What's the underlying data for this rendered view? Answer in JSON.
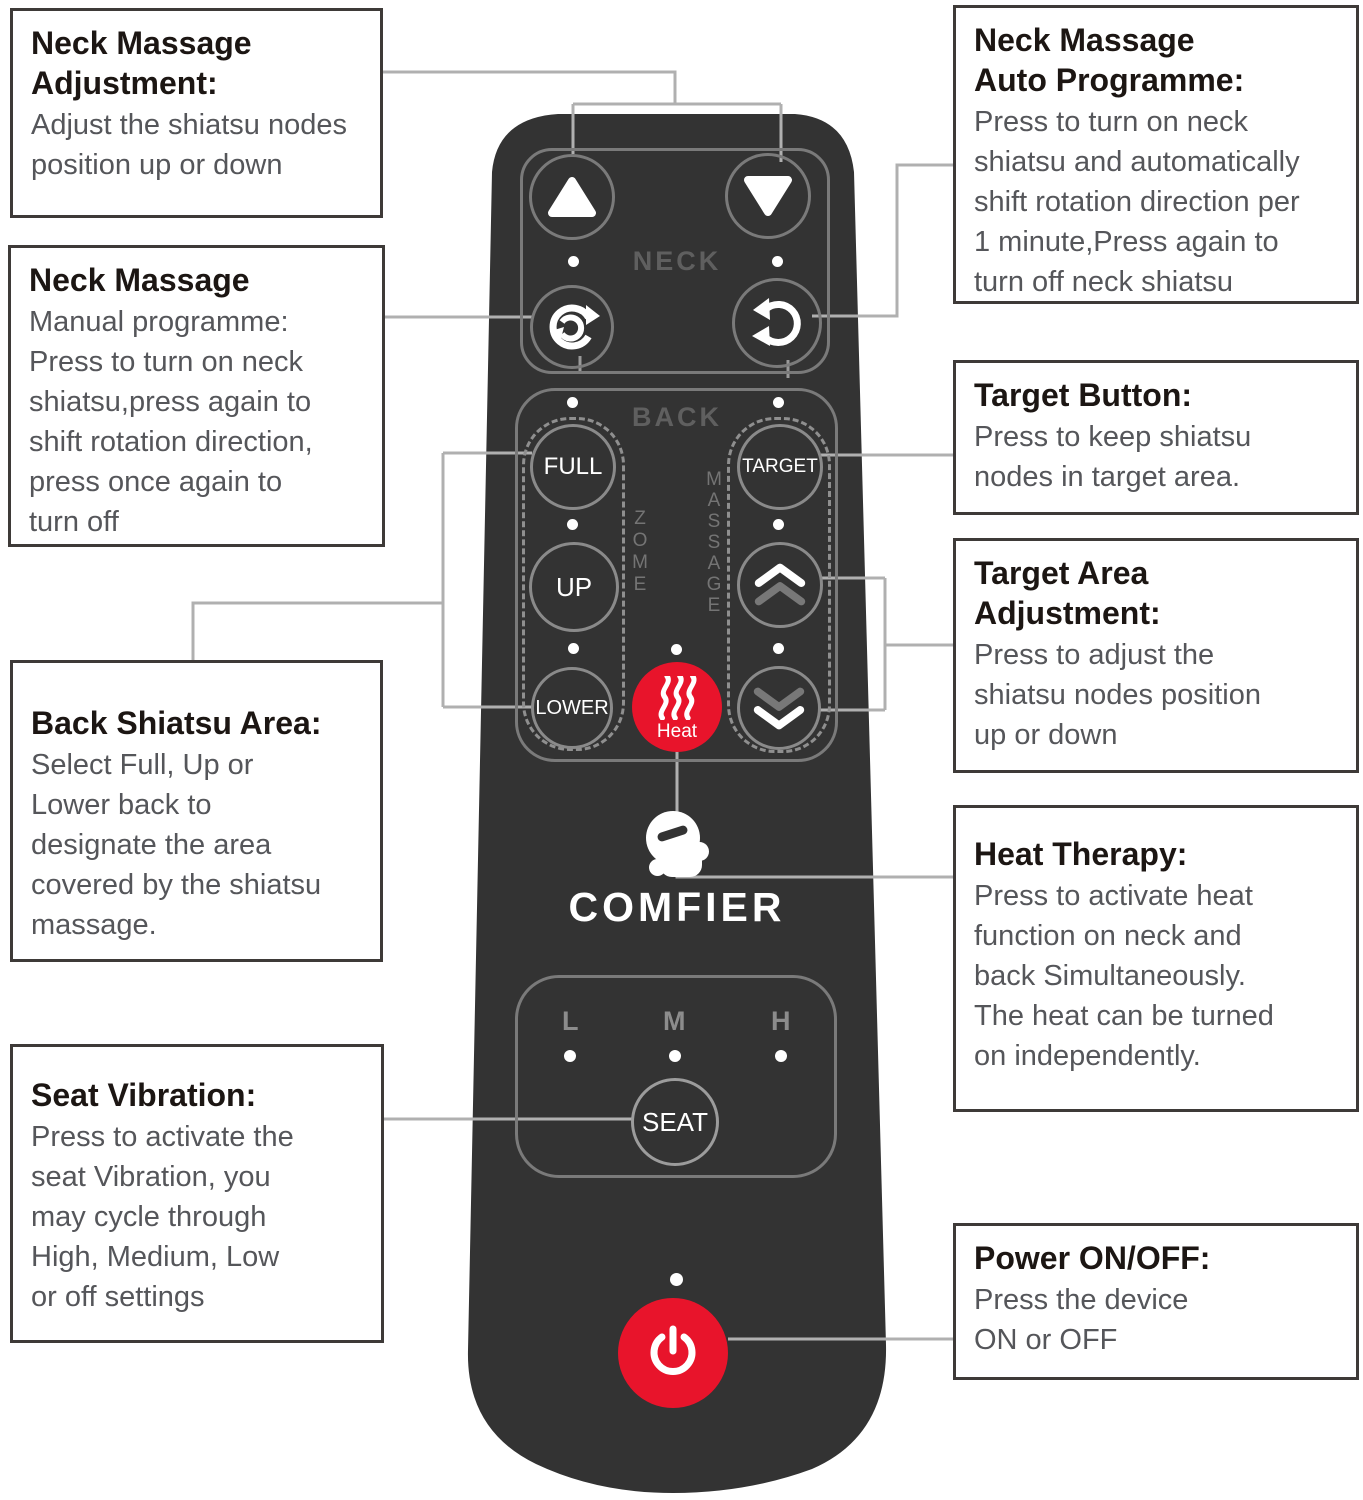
{
  "callouts": {
    "left": [
      {
        "title": "Neck Massage\nAdjustment:",
        "body": "Adjust the shiatsu nodes\nposition up or down"
      },
      {
        "title": "Neck Massage",
        "body": "Manual programme:\nPress to turn on neck\nshiatsu,press again to\nshift rotation direction,\npress once again to\nturn off"
      },
      {
        "title": "Back Shiatsu Area:",
        "body": "Select Full, Up or\nLower back to\ndesignate the area\ncovered by the shiatsu\nmassage."
      },
      {
        "title": "Seat Vibration:",
        "body": "Press to activate the\nseat Vibration, you\nmay cycle through\nHigh, Medium, Low\nor off settings"
      }
    ],
    "right": [
      {
        "title": "Neck Massage\nAuto Programme:",
        "body": "Press to turn on neck\nshiatsu and automatically\nshift rotation direction per\n1 minute,Press again to\nturn off neck shiatsu"
      },
      {
        "title": "Target Button:",
        "body": "Press to keep shiatsu\nnodes in target area."
      },
      {
        "title": "Target Area\nAdjustment:",
        "body": "Press to adjust the\nshiatsu nodes position\nup or down"
      },
      {
        "title": "Heat Therapy:",
        "body": "Press to activate heat\nfunction on neck and\nback Simultaneously.\nThe heat can be turned\non independently."
      },
      {
        "title": "Power ON/OFF:",
        "body": "Press the device\nON or OFF"
      }
    ]
  },
  "remote": {
    "brand": "COMFIER",
    "sections": {
      "neck": "NECK",
      "back": "BACK",
      "zone_vertical": "ZOME",
      "massage_vertical": "MASSAGE"
    },
    "buttons": {
      "full": "FULL",
      "up": "UP",
      "lower": "LOWER",
      "target": "TARGET",
      "heat": "Heat",
      "seat": "SEAT"
    },
    "vibration_levels": {
      "low": "L",
      "medium": "M",
      "high": "H"
    },
    "colors": {
      "body": "#333333",
      "accent_red": "#e8142b",
      "outline_gray": "#7a7a7a",
      "connector_gray": "#b0b0b0"
    }
  }
}
